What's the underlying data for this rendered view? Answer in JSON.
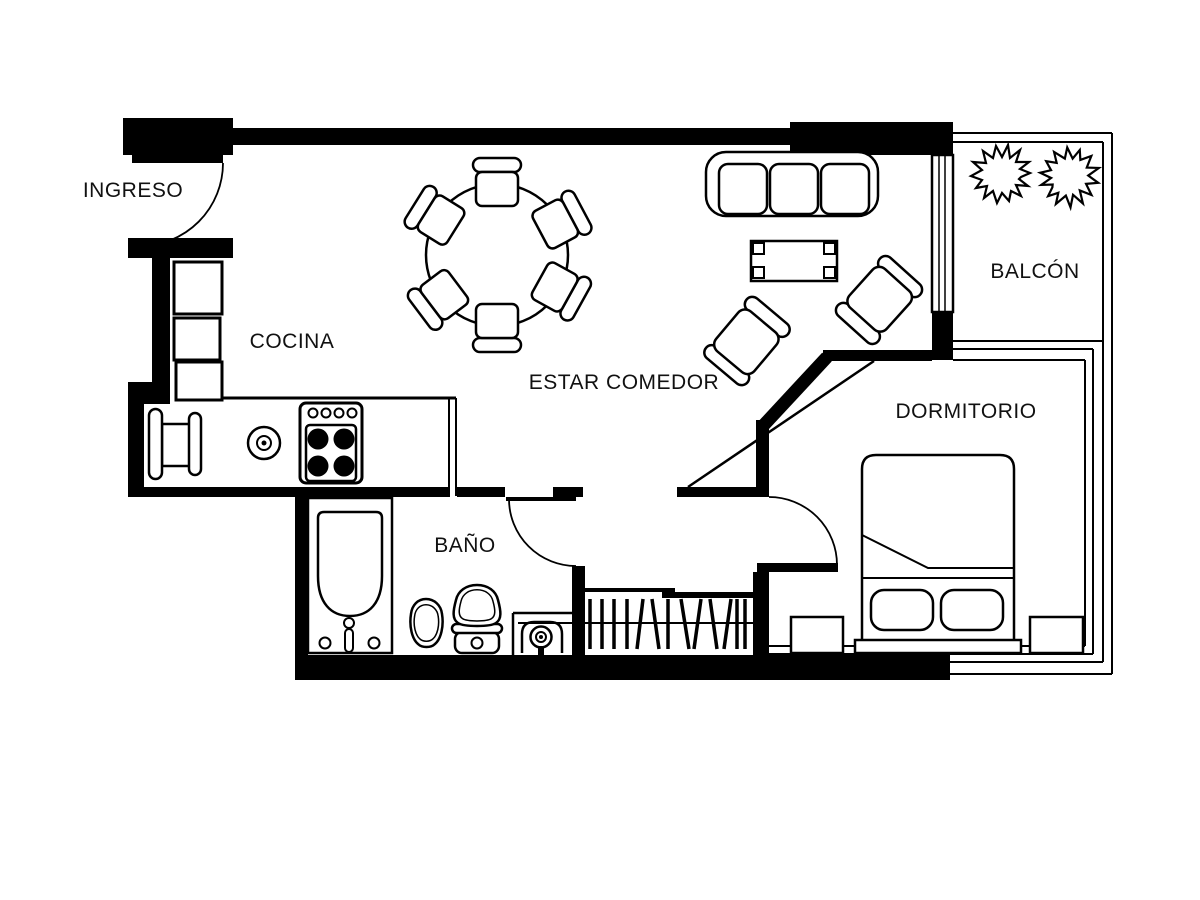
{
  "title": "apartment-floor-plan",
  "rooms": {
    "ingreso": {
      "label": "INGRESO"
    },
    "cocina": {
      "label": "COCINA"
    },
    "estar_comedor": {
      "label": "ESTAR COMEDOR"
    },
    "balcon": {
      "label": "BALCÓN"
    },
    "dormitorio": {
      "label": "DORMITORIO"
    },
    "bano": {
      "label": "BAÑO"
    }
  },
  "colors": {
    "wall": "#000000",
    "outline": "#000000",
    "background": "#ffffff",
    "text": "#111111"
  },
  "icons": {
    "plant": "plant-icon",
    "door_swing": "door-swing-arc"
  }
}
